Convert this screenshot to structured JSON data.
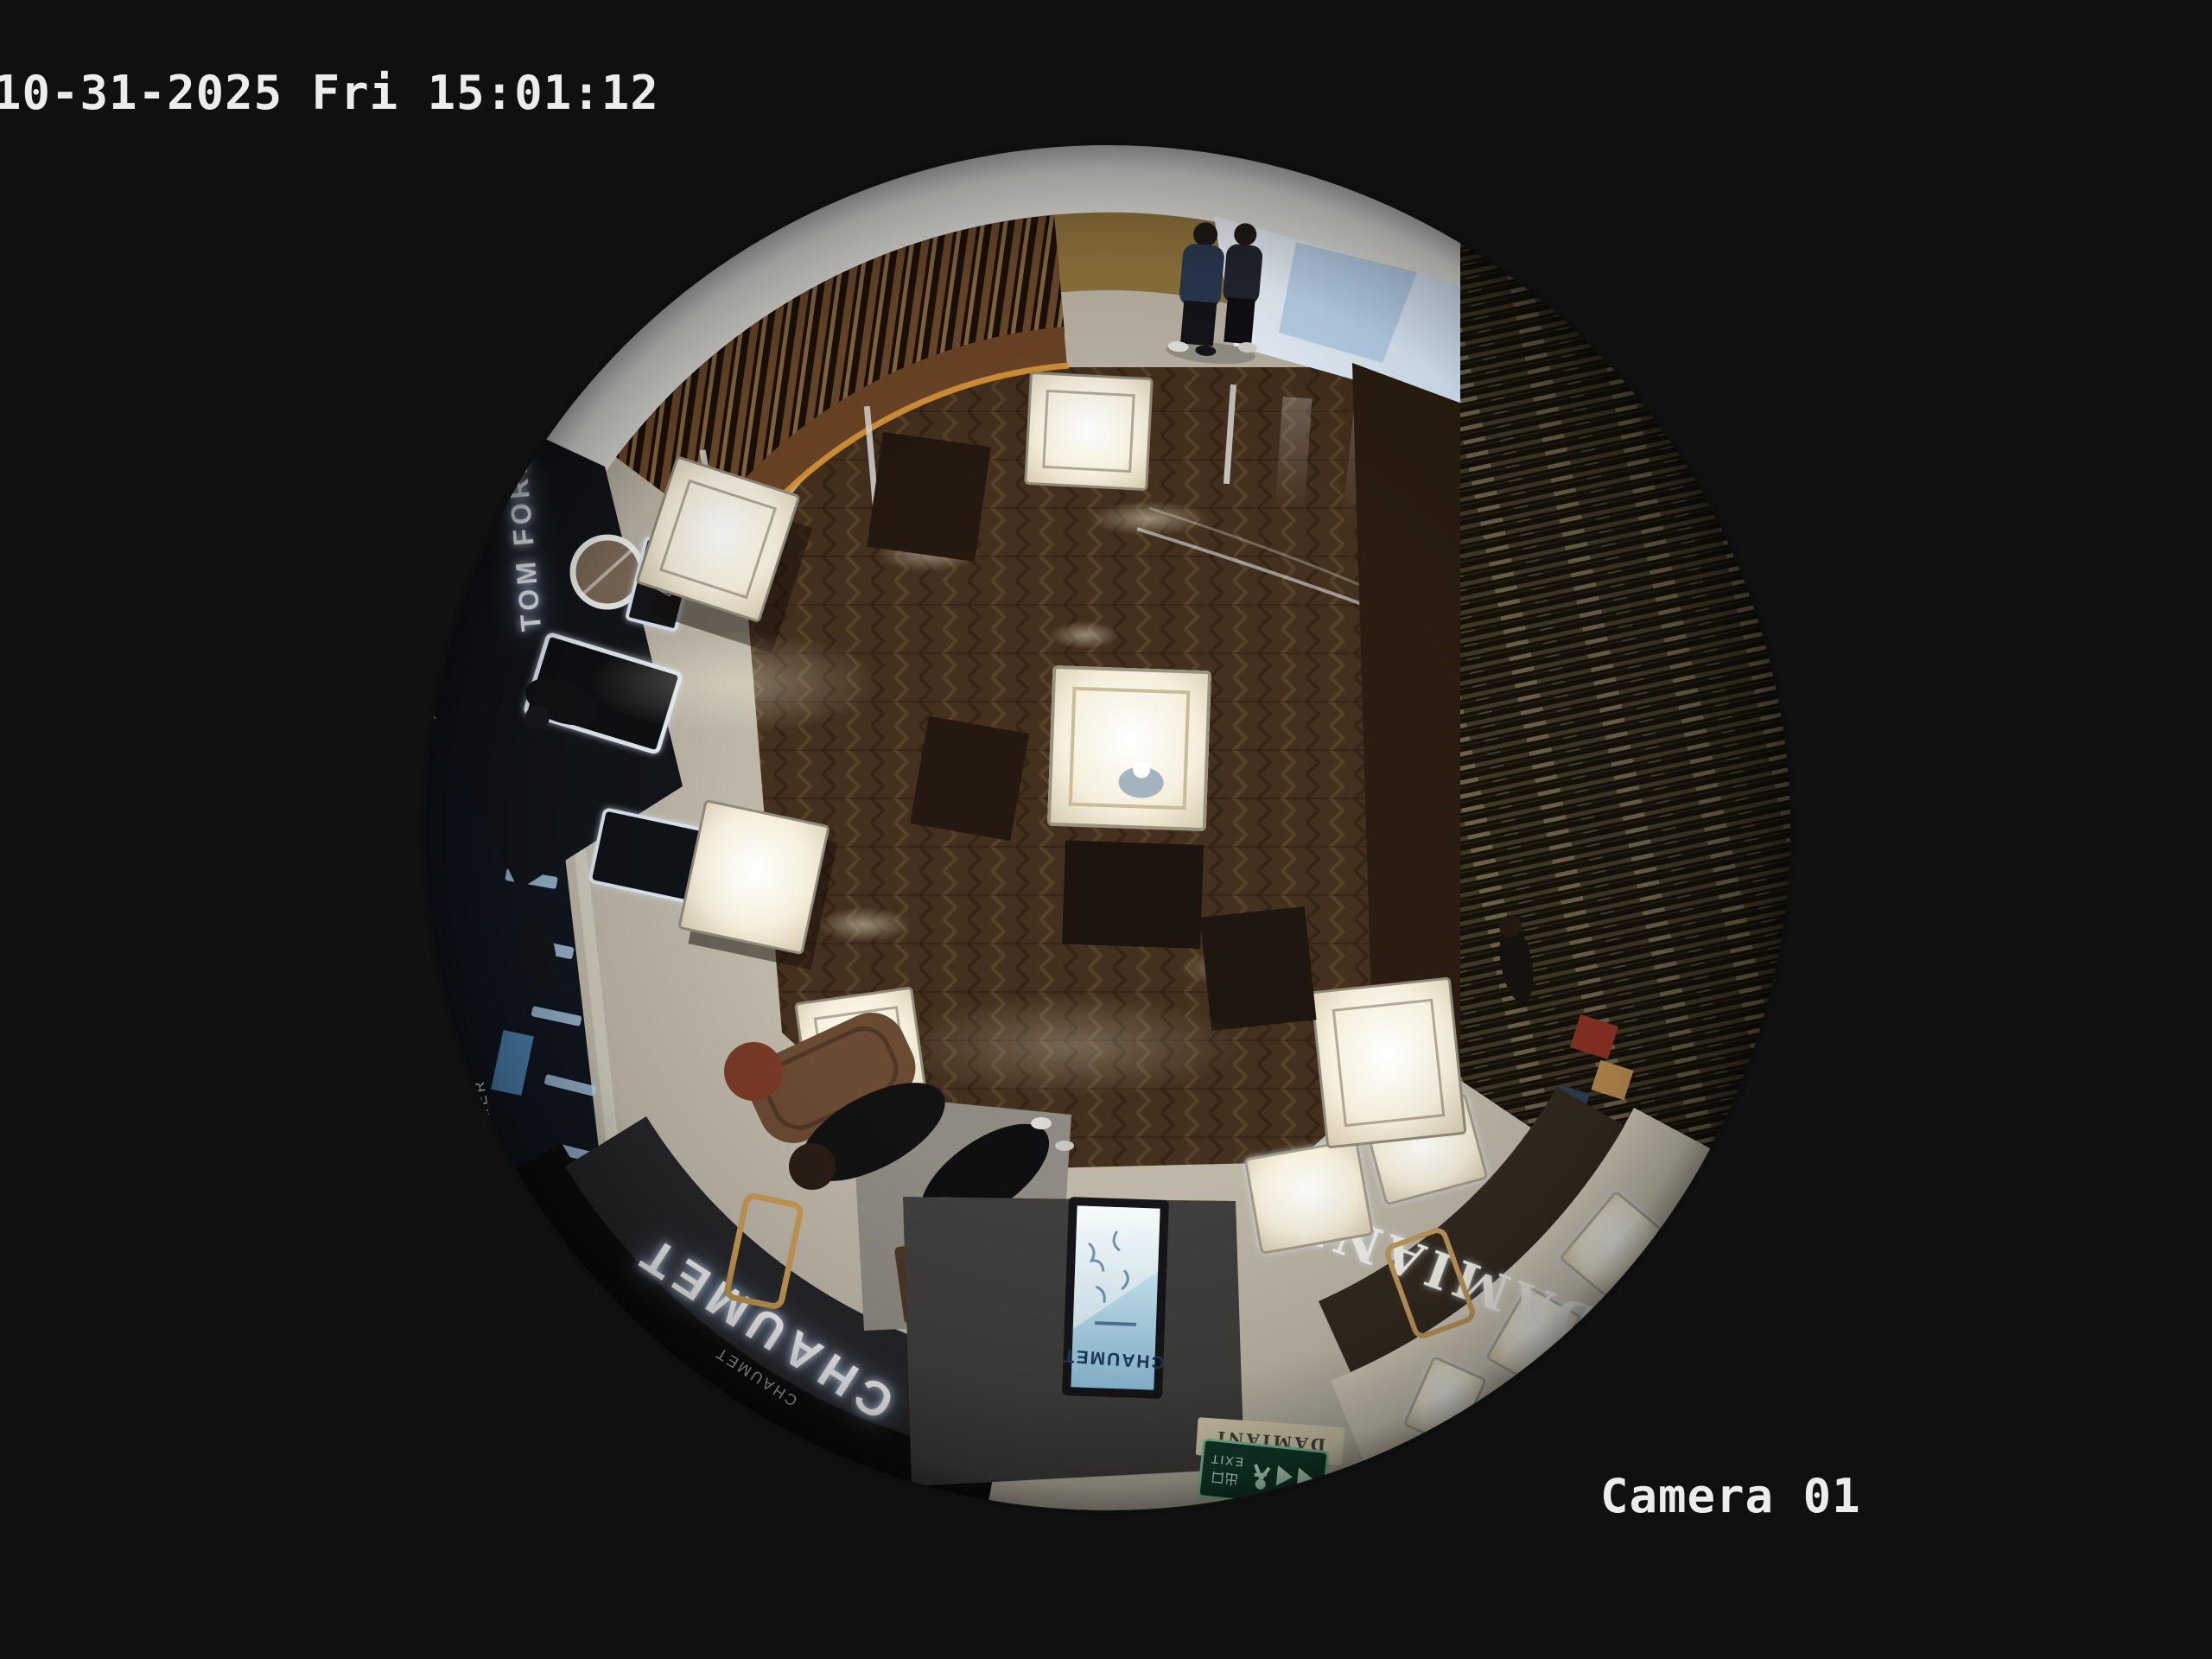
{
  "overlay": {
    "timestamp": "10-31-2025 Fri 15:01:12",
    "camera_label": "Camera 01"
  },
  "scene": {
    "signs": {
      "chaumet_fascia": "CHAUMET",
      "chaumet_sub": "CHAUMET",
      "chaumet_screen": "CHAUMET",
      "damiani_fascia": "DAMIANI",
      "damiani_lightbox": "DAMIANI",
      "tom_ford": "TOM FORD",
      "tf_monogram": "TF",
      "la_mer": "LA MER",
      "exit_en": "EXIT",
      "exit_cn": "出口"
    },
    "colors": {
      "background": "#101010",
      "marble": "#beb7a8",
      "wood_floor": "#44301e",
      "accent_gold": "#c79a58",
      "exit_green": "#123c2a",
      "screen_blue": "#8fc0da"
    }
  }
}
